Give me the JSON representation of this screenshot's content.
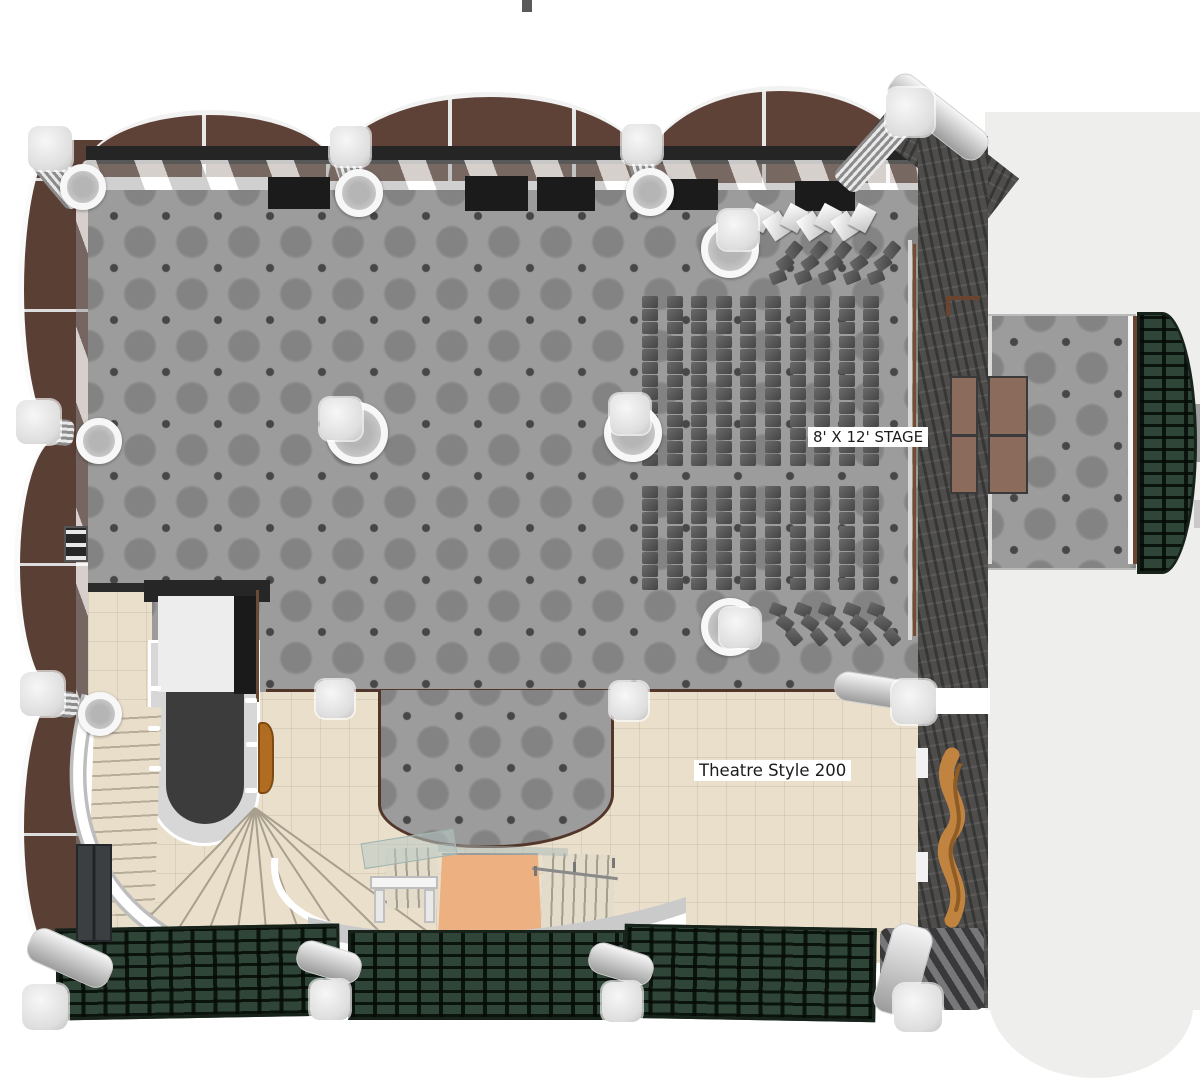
{
  "labels": {
    "stage": "8' X 12' STAGE",
    "theatre": "Theatre Style 200"
  },
  "palette": {
    "carpet_gray": "#9c9c9c",
    "carpet_dot": "#474747",
    "stone_wall": "#4e4d4b",
    "awning_brown": "#5e4237",
    "exterior_wall_brown": "#5a3f35",
    "foyer_tile": "#e9dfcb",
    "entrance_carpet": "#edb181",
    "stage_brown": "#8b6b5b",
    "canopy_green": "#2f4537",
    "column_white": "#efefef",
    "seat_gray": "#545454",
    "sculpture_gold": "#c08440",
    "terrace_gray": "#eeeeec",
    "trim_brown": "#53362a"
  },
  "plan": {
    "black_panels": [
      [
        268,
        177,
        62,
        32
      ],
      [
        465,
        176,
        63,
        35
      ],
      [
        537,
        177,
        58,
        34
      ],
      [
        658,
        179,
        60,
        31
      ],
      [
        795,
        181,
        60,
        30
      ]
    ],
    "stage_platforms": [
      [
        950,
        376,
        28,
        118
      ],
      [
        988,
        376,
        40,
        118
      ]
    ],
    "zigzag": {
      "x": 750,
      "y": 206,
      "count": 7,
      "dx": 17,
      "w": 20,
      "h": 24
    },
    "seating": {
      "seat_w": 16,
      "seat_h": 12,
      "blocks": [
        {
          "x": 642,
          "y": 296,
          "cols": 10,
          "colPitch": 24.6,
          "rows": 13,
          "rowPitch": 13.2,
          "wing": -1,
          "wingFrom": 5
        },
        {
          "x": 642,
          "y": 486,
          "cols": 10,
          "colPitch": 24.6,
          "rows": 8,
          "rowPitch": 13.2,
          "wing": 1,
          "wingFrom": 5
        }
      ],
      "wingSeats": 3
    },
    "columns": {
      "caps": [
        [
          28,
          126,
          44
        ],
        [
          330,
          126,
          40
        ],
        [
          622,
          124,
          40
        ],
        [
          886,
          88,
          48
        ],
        [
          16,
          400,
          44
        ],
        [
          20,
          672,
          44
        ],
        [
          320,
          398,
          42
        ],
        [
          610,
          394,
          40
        ],
        [
          718,
          210,
          40
        ],
        [
          720,
          608,
          40
        ],
        [
          316,
          680,
          38
        ],
        [
          610,
          682,
          38
        ],
        [
          892,
          680,
          44
        ],
        [
          22,
          984,
          46
        ],
        [
          310,
          980,
          40
        ],
        [
          602,
          982,
          40
        ],
        [
          894,
          984,
          48
        ]
      ],
      "rings": [
        [
          60,
          164,
          46
        ],
        [
          335,
          169,
          48
        ],
        [
          626,
          168,
          48
        ],
        [
          76,
          418,
          46
        ],
        [
          78,
          692,
          44
        ],
        [
          326,
          402,
          62
        ],
        [
          604,
          404,
          58
        ],
        [
          701,
          220,
          58
        ],
        [
          701,
          598,
          58
        ]
      ],
      "shafts": [
        [
          46,
          148,
          30,
          62,
          -40
        ],
        [
          338,
          144,
          26,
          50,
          -16
        ],
        [
          630,
          142,
          26,
          50,
          -16
        ],
        [
          856,
          112,
          30,
          84,
          42
        ],
        [
          34,
          404,
          26,
          54,
          -85
        ],
        [
          38,
          676,
          26,
          54,
          -85
        ]
      ],
      "cylinders": [
        [
          834,
          676,
          86,
          30,
          9
        ],
        [
          880,
          100,
          116,
          34,
          38
        ],
        [
          882,
          924,
          42,
          92,
          16
        ],
        [
          26,
          940,
          88,
          36,
          24
        ],
        [
          296,
          946,
          66,
          32,
          17
        ],
        [
          588,
          948,
          66,
          32,
          17
        ]
      ]
    },
    "rail_ticks": [
      [
        149,
        686
      ],
      [
        148,
        726
      ],
      [
        149,
        766
      ],
      [
        245,
        698
      ],
      [
        246,
        742
      ],
      [
        245,
        788
      ]
    ]
  }
}
